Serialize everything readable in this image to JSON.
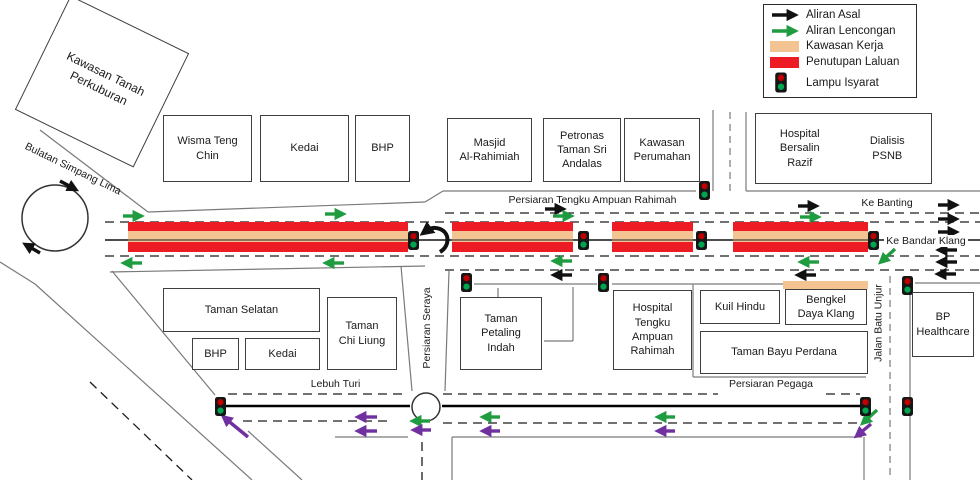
{
  "legend": {
    "items": [
      {
        "label": "Aliran Asal",
        "type": "black-arrow"
      },
      {
        "label": "Aliran Lencongan",
        "type": "green-arrow"
      },
      {
        "label": "Kawasan Kerja",
        "type": "tan-swatch"
      },
      {
        "label": "Penutupan Laluan",
        "type": "red-swatch"
      },
      {
        "label": "Lampu  Isyarat",
        "type": "traffic-light"
      }
    ]
  },
  "areas": {
    "kawasan_tanah": "Kawasan Tanah\nPerkuburan",
    "wisma": "Wisma Teng\nChin",
    "kedai_top": "Kedai",
    "bhp_top": "BHP",
    "masjid": "Masjid\nAl-Rahimiah",
    "petronas": "Petronas\nTaman Sri\nAndalas",
    "kawasan_perumahan": "Kawasan\nPerumahan",
    "hospital_bersalin": "Hospital\nBersalin\nRazif",
    "dialisis": "Dialisis\nPSNB",
    "taman_selatan": "Taman Selatan",
    "bhp_lower": "BHP",
    "kedai_lower": "Kedai",
    "taman_chi_liung": "Taman\nChi Liung",
    "taman_petaling": "Taman\nPetaling\nIndah",
    "hospital_tar": "Hospital\nTengku\nAmpuan\nRahimah",
    "kuil_hindu": "Kuil Hindu",
    "bengkel": "Bengkel\nDaya Klang",
    "taman_bayu": "Taman Bayu Perdana",
    "bp_healthcare": "BP\nHealthcare"
  },
  "roads": {
    "ptar": "Persiaran Tengku Ampuan Rahimah",
    "bulatan": "Bulatan Simpang Lima",
    "seraya": "Persiaran Seraya",
    "lebuh_turi": "Lebuh Turi",
    "pegaga": "Persiaran Pegaga",
    "batu_unjur": "Jalan Batu Unjur",
    "ke_banting": "Ke Banting",
    "ke_bandar_klang": "Ke Bandar Klang"
  },
  "colors": {
    "closure_red": "#ED1C24",
    "work_tan": "#F3C492",
    "flow_green": "#1E9C3F",
    "diversion_purple": "#7030A0",
    "flow_black": "#111111",
    "light_red": "#C00000",
    "light_green": "#00A550"
  }
}
